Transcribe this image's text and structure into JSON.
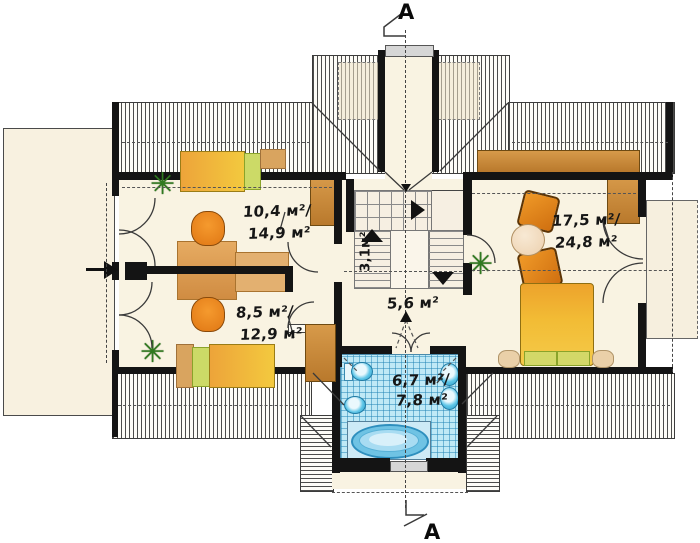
{
  "markers": {
    "top": "A",
    "bottom": "A"
  },
  "rooms": {
    "top_left": {
      "line1": "10,4 м²/",
      "line2": "14,9 м²"
    },
    "bottom_left": {
      "line1": "8,5 м²/",
      "line2": "12,9 м²"
    },
    "stairs": {
      "label": "3,1м²"
    },
    "hall": {
      "label": "5,6 м²"
    },
    "bathroom": {
      "line1": "6,7 м²/",
      "line2": "7,8 м²"
    },
    "bedroom": {
      "line1": "17,5 м²/",
      "line2": "24,8 м²"
    }
  },
  "colors": {
    "floor": "#f9f3e2",
    "terrace": "#f8f1e0",
    "wall": "#141414",
    "hatch_line": "#3c3c3c",
    "desk_tan": "#dfa763",
    "chair_orange": "#ee8a1d",
    "bed_yellow": "#f4c838",
    "pillow_green": "#ccda67",
    "wardrobe_brown": "#c8863a",
    "tile_blue": "#bfe9f6",
    "tub_blue": "#2e8fbe",
    "plant_green": "#2f7a1f"
  }
}
